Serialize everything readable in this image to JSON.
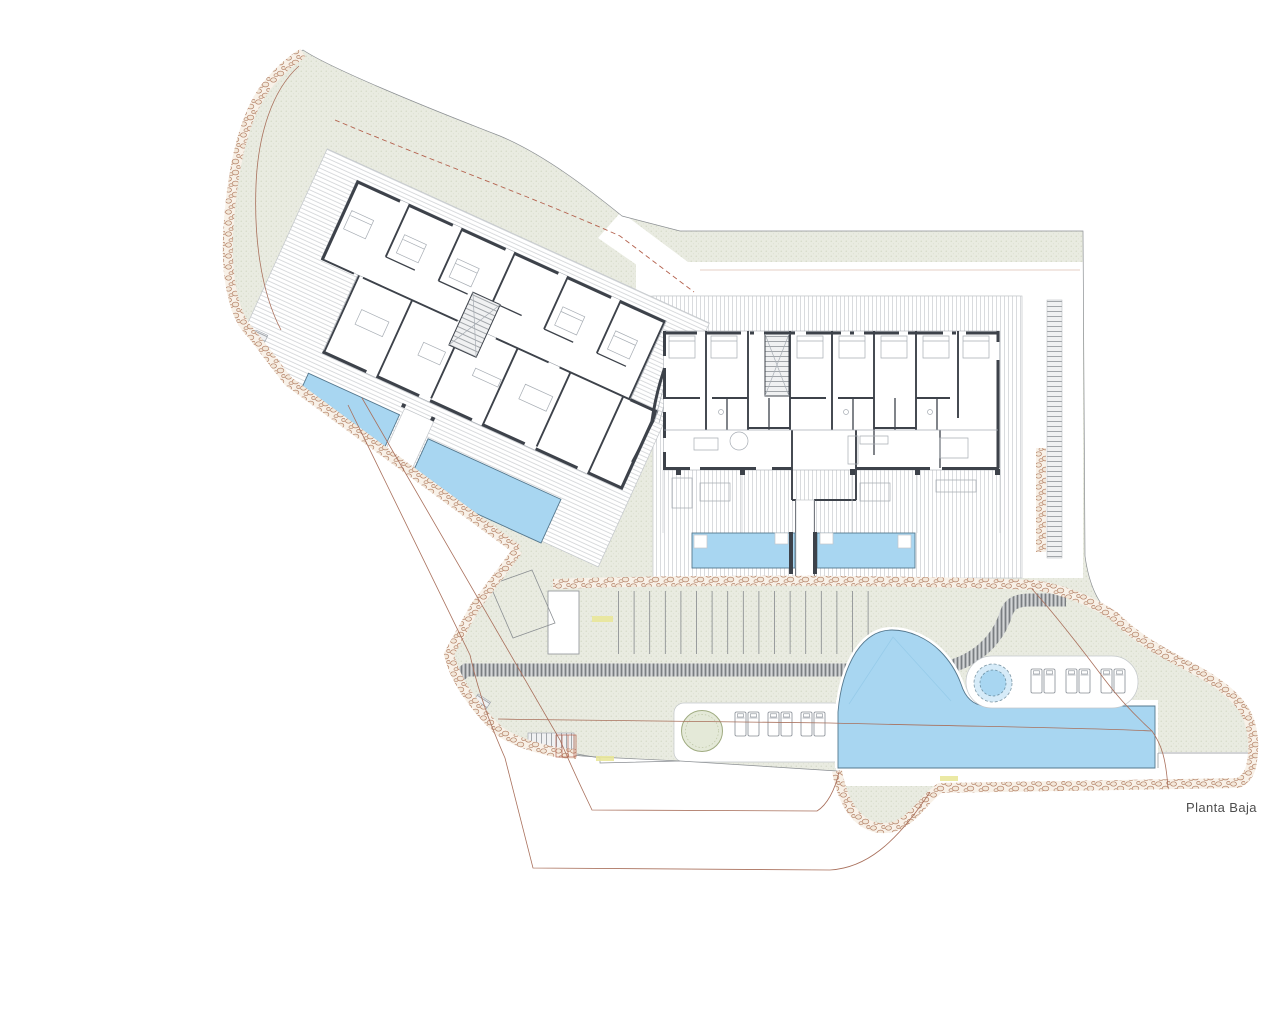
{
  "plan": {
    "floor_label": "Planta Baja"
  },
  "palette": {
    "site_green": "#e9ebe1",
    "site_dot": "#c6cdb4",
    "pool_blue": "#a8d6f1",
    "pool_edge": "#55788e",
    "wall_dark": "#3d424a",
    "furn_gray": "#a7adb4",
    "deck_stripe": "#c9cccf",
    "road_bg": "#d3d5d7",
    "road_tick": "#797d81",
    "ladder_gray": "#a2a6aa",
    "pebble_line": "#b5846a",
    "pebble_bg": "#f8f1e8",
    "line_brown": "#a9705c",
    "line_red": "#b4624e",
    "mark_yellow": "#e9e79a",
    "text_gray": "#4d4d4d"
  },
  "features": {
    "buildings": 2,
    "apartment_pools": 4,
    "main_pool": 1,
    "spa": 1,
    "planter": 1,
    "parking_stall_lines": 17,
    "loungers_south": 6,
    "loungers_east": 6
  }
}
